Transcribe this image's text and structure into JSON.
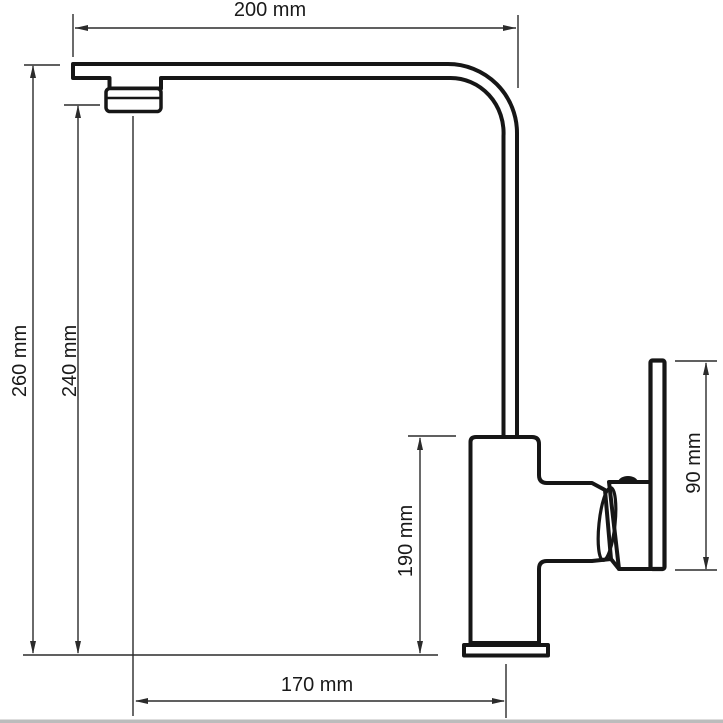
{
  "diagram": {
    "type": "technical-drawing",
    "subject": "kitchen-faucet-side-view",
    "unit": "mm",
    "colors": {
      "background": "#ffffff",
      "outline": "#161616",
      "dimension_lines": "#2b2b2b",
      "label_text": "#1a1a1a"
    },
    "dimensions": [
      {
        "id": "spout-reach-top",
        "label": "200 mm",
        "value": 200,
        "unit": "mm",
        "orientation": "horizontal"
      },
      {
        "id": "overall-height",
        "label": "260 mm",
        "value": 260,
        "unit": "mm",
        "orientation": "vertical"
      },
      {
        "id": "spout-outlet-height",
        "label": "240 mm",
        "value": 240,
        "unit": "mm",
        "orientation": "vertical"
      },
      {
        "id": "body-height",
        "label": "190 mm",
        "value": 190,
        "unit": "mm",
        "orientation": "vertical"
      },
      {
        "id": "handle-height",
        "label": "90 mm",
        "value": 90,
        "unit": "mm",
        "orientation": "vertical"
      },
      {
        "id": "base-reach-bottom",
        "label": "170 mm",
        "value": 170,
        "unit": "mm",
        "orientation": "horizontal"
      }
    ]
  }
}
